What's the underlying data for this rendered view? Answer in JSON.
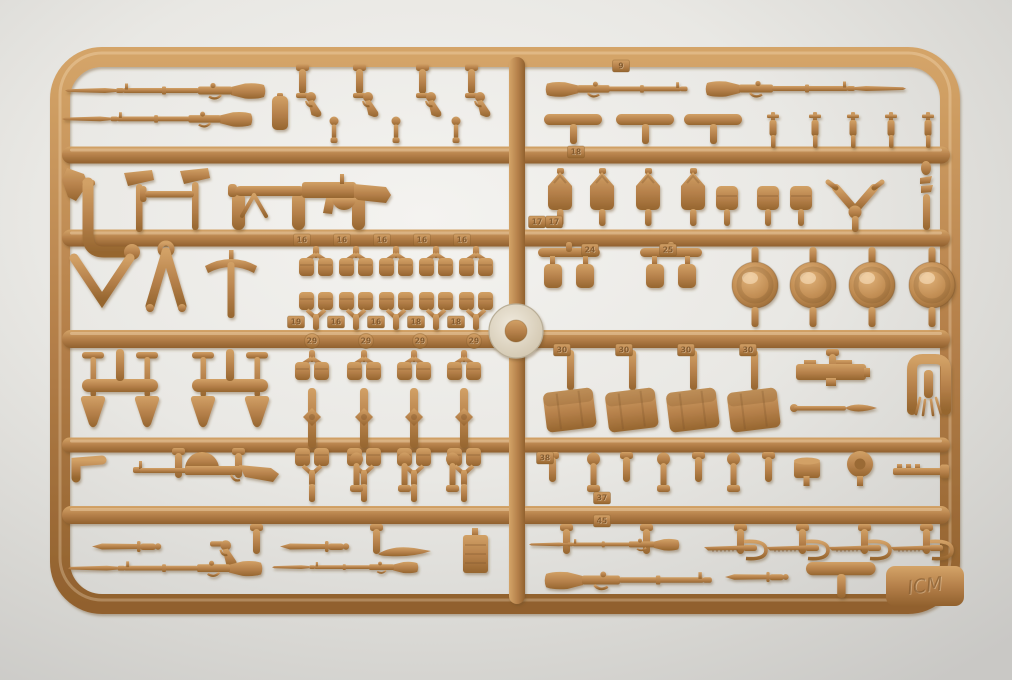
{
  "photo": {
    "background_center": "#f4f3f0",
    "background_mid": "#e9e8e4",
    "background_edge": "#d6d5d1",
    "background_corner": "#c9c8c5"
  },
  "palette": {
    "plastic_light": "#d4a468",
    "plastic_mid": "#b5804a",
    "plastic_dark": "#91612e",
    "plastic_highlight": "#e7c291",
    "disc_light": "#efe9dc",
    "disc_dark": "#cfc3ab"
  },
  "sprue": {
    "frame": {
      "x": 60,
      "y": 57,
      "w": 890,
      "h": 547,
      "r": 42,
      "t": 20
    },
    "h_rails": [
      {
        "y": 155,
        "x1": 62,
        "x2": 950,
        "t": 17
      },
      {
        "y": 238,
        "x1": 62,
        "x2": 950,
        "t": 17
      },
      {
        "y": 339,
        "x1": 62,
        "x2": 950,
        "t": 18
      },
      {
        "y": 445,
        "x1": 62,
        "x2": 950,
        "t": 15
      },
      {
        "y": 515,
        "x1": 62,
        "x2": 950,
        "t": 18
      }
    ],
    "v_rails": [
      {
        "x": 517,
        "y1": 57,
        "y2": 604,
        "t": 16
      }
    ],
    "disc": {
      "cx": 516,
      "cy": 331,
      "r": 27,
      "r_inner": 11
    },
    "logo": {
      "x": 886,
      "y": 566,
      "w": 78,
      "h": 40,
      "text": "ICM"
    }
  },
  "parts": [
    {
      "t": "rifle_b",
      "x": 265,
      "y": 78,
      "fx": 1,
      "n": "rifle-with-bayonet"
    },
    {
      "t": "rifle_b",
      "x": 252,
      "y": 107,
      "fx": 1,
      "s": 0.95,
      "n": "rifle-with-bayonet"
    },
    {
      "t": "flask",
      "x": 272,
      "y": 96,
      "n": "holster"
    },
    {
      "t": "gate",
      "x": 296,
      "y": 64,
      "n": "sprue-gate"
    },
    {
      "t": "gate",
      "x": 353,
      "y": 64,
      "n": "sprue-gate"
    },
    {
      "t": "gate",
      "x": 416,
      "y": 64,
      "n": "sprue-gate"
    },
    {
      "t": "gate",
      "x": 465,
      "y": 64,
      "n": "sprue-gate"
    },
    {
      "t": "pistol",
      "x": 296,
      "y": 88,
      "n": "revolver"
    },
    {
      "t": "pistol",
      "x": 353,
      "y": 88,
      "n": "revolver"
    },
    {
      "t": "pistol",
      "x": 416,
      "y": 88,
      "n": "revolver"
    },
    {
      "t": "pistol",
      "x": 465,
      "y": 88,
      "n": "revolver"
    },
    {
      "t": "grenade",
      "x": 328,
      "y": 116,
      "n": "grenade"
    },
    {
      "t": "grenade",
      "x": 390,
      "y": 116,
      "n": "grenade"
    },
    {
      "t": "grenade",
      "x": 450,
      "y": 116,
      "n": "grenade"
    },
    {
      "t": "rifle",
      "x": 546,
      "y": 77,
      "s": 0.95,
      "n": "rifle"
    },
    {
      "t": "rifle_b",
      "x": 706,
      "y": 76,
      "n": "rifle-with-bayonet"
    },
    {
      "t": "magbar",
      "x": 544,
      "y": 114,
      "n": "magazine"
    },
    {
      "t": "magbar",
      "x": 616,
      "y": 114,
      "n": "magazine"
    },
    {
      "t": "magbar",
      "x": 684,
      "y": 114,
      "n": "magazine"
    },
    {
      "t": "rgren",
      "x": 764,
      "y": 112,
      "n": "rifle-grenade"
    },
    {
      "t": "rgren",
      "x": 806,
      "y": 112,
      "n": "rifle-grenade"
    },
    {
      "t": "rgren",
      "x": 844,
      "y": 112,
      "n": "rifle-grenade"
    },
    {
      "t": "rgren",
      "x": 882,
      "y": 112,
      "n": "rifle-grenade"
    },
    {
      "t": "rgren",
      "x": 919,
      "y": 112,
      "n": "rifle-grenade"
    },
    {
      "t": "wedge",
      "x": 62,
      "y": 168,
      "n": "holster-flap"
    },
    {
      "t": "jpipe",
      "x": 78,
      "y": 180,
      "n": "pipe-elbow"
    },
    {
      "t": "axe",
      "x": 124,
      "y": 170,
      "n": "axe-head"
    },
    {
      "t": "axe",
      "x": 180,
      "y": 168,
      "n": "axe-head"
    },
    {
      "t": "tbar",
      "x": 140,
      "y": 186,
      "n": "handle-bar"
    },
    {
      "t": "pill",
      "x": 232,
      "y": 192,
      "n": "sprue-gate"
    },
    {
      "t": "pill",
      "x": 292,
      "y": 192,
      "n": "sprue-gate"
    },
    {
      "t": "pill",
      "x": 352,
      "y": 192,
      "n": "sprue-gate"
    },
    {
      "t": "mg",
      "x": 228,
      "y": 176,
      "n": "lewis-gun"
    },
    {
      "t": "canteen",
      "x": 545,
      "y": 168,
      "n": "canteen"
    },
    {
      "t": "canteen",
      "x": 587,
      "y": 168,
      "n": "canteen"
    },
    {
      "t": "canteen",
      "x": 633,
      "y": 168,
      "n": "canteen"
    },
    {
      "t": "canteen",
      "x": 678,
      "y": 168,
      "n": "canteen"
    },
    {
      "t": "pouch1",
      "x": 716,
      "y": 186,
      "n": "pouch"
    },
    {
      "t": "pouch1",
      "x": 757,
      "y": 186,
      "n": "pouch"
    },
    {
      "t": "pouch1",
      "x": 790,
      "y": 186,
      "n": "pouch"
    },
    {
      "t": "wishbone",
      "x": 826,
      "y": 176,
      "n": "branch-fork"
    },
    {
      "t": "zigzag",
      "x": 916,
      "y": 162,
      "n": "stacked-small-parts"
    },
    {
      "t": "chevron",
      "x": 70,
      "y": 254,
      "n": "v-brace"
    },
    {
      "t": "aframe",
      "x": 138,
      "y": 242,
      "n": "folding-bipod"
    },
    {
      "t": "pick",
      "x": 203,
      "y": 250,
      "n": "pickaxe"
    },
    {
      "t": "ppair",
      "x": 298,
      "y": 246,
      "n": "pouch-pair"
    },
    {
      "t": "ppair",
      "x": 338,
      "y": 246,
      "n": "pouch-pair"
    },
    {
      "t": "ppair",
      "x": 378,
      "y": 246,
      "n": "pouch-pair"
    },
    {
      "t": "ppair",
      "x": 418,
      "y": 246,
      "n": "pouch-pair"
    },
    {
      "t": "ppair",
      "x": 458,
      "y": 246,
      "n": "pouch-pair"
    },
    {
      "t": "ppair2",
      "x": 298,
      "y": 290,
      "n": "pouch-pair"
    },
    {
      "t": "ppair2",
      "x": 338,
      "y": 290,
      "n": "pouch-pair"
    },
    {
      "t": "ppair2",
      "x": 378,
      "y": 290,
      "n": "pouch-pair"
    },
    {
      "t": "ppair2",
      "x": 418,
      "y": 290,
      "n": "pouch-pair"
    },
    {
      "t": "ppair2",
      "x": 458,
      "y": 290,
      "n": "pouch-pair"
    },
    {
      "t": "ppairbar",
      "x": 538,
      "y": 248,
      "n": "pouch-pair"
    },
    {
      "t": "ppairbar",
      "x": 640,
      "y": 248,
      "n": "pouch-pair"
    },
    {
      "t": "helmet",
      "x": 730,
      "y": 247,
      "n": "helmet"
    },
    {
      "t": "helmet",
      "x": 788,
      "y": 247,
      "n": "helmet"
    },
    {
      "t": "helmet",
      "x": 847,
      "y": 247,
      "n": "helmet"
    },
    {
      "t": "helmet",
      "x": 907,
      "y": 247,
      "n": "helmet"
    },
    {
      "t": "shovels2",
      "x": 78,
      "y": 349,
      "n": "shovel-pair"
    },
    {
      "t": "shovels2",
      "x": 188,
      "y": 349,
      "n": "shovel-pair"
    },
    {
      "t": "hcol",
      "x": 292,
      "y": 350,
      "n": "pouch-column"
    },
    {
      "t": "hcol",
      "x": 344,
      "y": 350,
      "n": "pouch-column"
    },
    {
      "t": "hcol",
      "x": 394,
      "y": 350,
      "n": "pouch-column"
    },
    {
      "t": "hcol",
      "x": 444,
      "y": 350,
      "n": "pouch-column"
    },
    {
      "t": "satchel",
      "x": 541,
      "y": 350,
      "n": "satchel-bag"
    },
    {
      "t": "satchel",
      "x": 603,
      "y": 350,
      "n": "satchel-bag"
    },
    {
      "t": "satchel",
      "x": 664,
      "y": 350,
      "n": "satchel-bag"
    },
    {
      "t": "satchel",
      "x": 725,
      "y": 350,
      "n": "satchel-bag"
    },
    {
      "t": "gate",
      "x": 826,
      "y": 349,
      "n": "sprue-gate"
    },
    {
      "t": "devicebox",
      "x": 796,
      "y": 360,
      "n": "receiver-block"
    },
    {
      "t": "spear",
      "x": 790,
      "y": 400,
      "n": "scabbard-rod"
    },
    {
      "t": "clamp",
      "x": 903,
      "y": 352,
      "n": "clamp"
    },
    {
      "t": "angle",
      "x": 70,
      "y": 454,
      "n": "bracket"
    },
    {
      "t": "gate",
      "x": 172,
      "y": 448,
      "n": "sprue-gate"
    },
    {
      "t": "gate",
      "x": 232,
      "y": 448,
      "n": "sprue-gate"
    },
    {
      "t": "scoped",
      "x": 133,
      "y": 452,
      "n": "drum-magazine-rifle"
    },
    {
      "t": "gatepin",
      "x": 348,
      "y": 452,
      "n": "sprue-pin"
    },
    {
      "t": "gatepin",
      "x": 396,
      "y": 452,
      "n": "sprue-pin"
    },
    {
      "t": "gatepin",
      "x": 444,
      "y": 452,
      "n": "sprue-pin"
    },
    {
      "t": "gate",
      "x": 546,
      "y": 452,
      "n": "sprue-gate"
    },
    {
      "t": "gatepin",
      "x": 585,
      "y": 452,
      "n": "sprue-pin"
    },
    {
      "t": "gatepin",
      "x": 655,
      "y": 452,
      "n": "sprue-pin"
    },
    {
      "t": "gatepin",
      "x": 725,
      "y": 452,
      "n": "sprue-pin"
    },
    {
      "t": "gate",
      "x": 620,
      "y": 452,
      "n": "sprue-gate"
    },
    {
      "t": "gate",
      "x": 692,
      "y": 452,
      "n": "sprue-gate"
    },
    {
      "t": "gate",
      "x": 762,
      "y": 452,
      "n": "sprue-gate"
    },
    {
      "t": "drum",
      "x": 793,
      "y": 456,
      "n": "drum-part"
    },
    {
      "t": "wheel",
      "x": 845,
      "y": 450,
      "n": "disc-part"
    },
    {
      "t": "clip",
      "x": 893,
      "y": 462,
      "n": "clip-part"
    },
    {
      "t": "gate",
      "x": 250,
      "y": 524,
      "n": "sprue-gate"
    },
    {
      "t": "gate",
      "x": 370,
      "y": 524,
      "n": "sprue-gate"
    },
    {
      "t": "bayonet",
      "x": 92,
      "y": 540,
      "n": "bayonet"
    },
    {
      "t": "pistol",
      "x": 210,
      "y": 536,
      "s": 1.05,
      "n": "pistol-part"
    },
    {
      "t": "bayonet",
      "x": 280,
      "y": 540,
      "n": "bayonet"
    },
    {
      "t": "scabflat",
      "x": 376,
      "y": 543,
      "n": "scabbard"
    },
    {
      "t": "ammobox",
      "x": 463,
      "y": 528,
      "n": "ammo-box"
    },
    {
      "t": "rifle_b",
      "x": 262,
      "y": 556,
      "fx": 1,
      "s": 0.97,
      "n": "rifle-with-bayonet"
    },
    {
      "t": "rifle_b",
      "x": 418,
      "y": 558,
      "fx": 1,
      "s": 0.73,
      "n": "rifle-with-bayonet"
    },
    {
      "t": "gate",
      "x": 560,
      "y": 524,
      "n": "sprue-gate"
    },
    {
      "t": "gate",
      "x": 640,
      "y": 524,
      "n": "sprue-gate"
    },
    {
      "t": "rifle_b",
      "x": 679,
      "y": 535,
      "fx": 1,
      "s": 0.75,
      "n": "rifle-with-bayonet"
    },
    {
      "t": "gate",
      "x": 734,
      "y": 524,
      "n": "sprue-gate"
    },
    {
      "t": "gate",
      "x": 796,
      "y": 524,
      "n": "sprue-gate"
    },
    {
      "t": "gate",
      "x": 858,
      "y": 524,
      "n": "sprue-gate"
    },
    {
      "t": "gate",
      "x": 920,
      "y": 524,
      "n": "sprue-gate"
    },
    {
      "t": "sword",
      "x": 704,
      "y": 538,
      "n": "sword"
    },
    {
      "t": "sword",
      "x": 766,
      "y": 538,
      "n": "sword"
    },
    {
      "t": "sword",
      "x": 828,
      "y": 538,
      "n": "sword"
    },
    {
      "t": "sword",
      "x": 890,
      "y": 538,
      "n": "sword"
    },
    {
      "t": "rifle",
      "x": 545,
      "y": 566,
      "s": 1.12,
      "n": "rifle"
    },
    {
      "t": "bayonet",
      "x": 725,
      "y": 571,
      "s": 0.92,
      "n": "bayonet"
    },
    {
      "t": "magbar",
      "x": 806,
      "y": 562,
      "s": 1.2,
      "n": "scabbard"
    }
  ],
  "tabs": [
    {
      "l": "9",
      "x": 621,
      "y": 66
    },
    {
      "l": "18",
      "x": 576,
      "y": 152
    },
    {
      "l": "16",
      "x": 302,
      "y": 240
    },
    {
      "l": "16",
      "x": 342,
      "y": 240
    },
    {
      "l": "16",
      "x": 382,
      "y": 240
    },
    {
      "l": "16",
      "x": 422,
      "y": 240
    },
    {
      "l": "16",
      "x": 462,
      "y": 240
    },
    {
      "l": "17",
      "x": 537,
      "y": 222
    },
    {
      "l": "17",
      "x": 554,
      "y": 222
    },
    {
      "l": "24",
      "x": 590,
      "y": 250
    },
    {
      "l": "25",
      "x": 668,
      "y": 250
    },
    {
      "l": "19",
      "x": 296,
      "y": 322
    },
    {
      "l": "16",
      "x": 336,
      "y": 322
    },
    {
      "l": "16",
      "x": 376,
      "y": 322
    },
    {
      "l": "18",
      "x": 416,
      "y": 322
    },
    {
      "l": "18",
      "x": 456,
      "y": 322
    },
    {
      "l": "29",
      "x": 312,
      "y": 341,
      "round": true
    },
    {
      "l": "29",
      "x": 366,
      "y": 341,
      "round": true
    },
    {
      "l": "29",
      "x": 420,
      "y": 341,
      "round": true
    },
    {
      "l": "29",
      "x": 474,
      "y": 341,
      "round": true
    },
    {
      "l": "30",
      "x": 562,
      "y": 350
    },
    {
      "l": "30",
      "x": 624,
      "y": 350
    },
    {
      "l": "30",
      "x": 686,
      "y": 350
    },
    {
      "l": "30",
      "x": 748,
      "y": 350
    },
    {
      "l": "38",
      "x": 545,
      "y": 458
    },
    {
      "l": "37",
      "x": 602,
      "y": 498
    },
    {
      "l": "45",
      "x": 602,
      "y": 521
    }
  ]
}
